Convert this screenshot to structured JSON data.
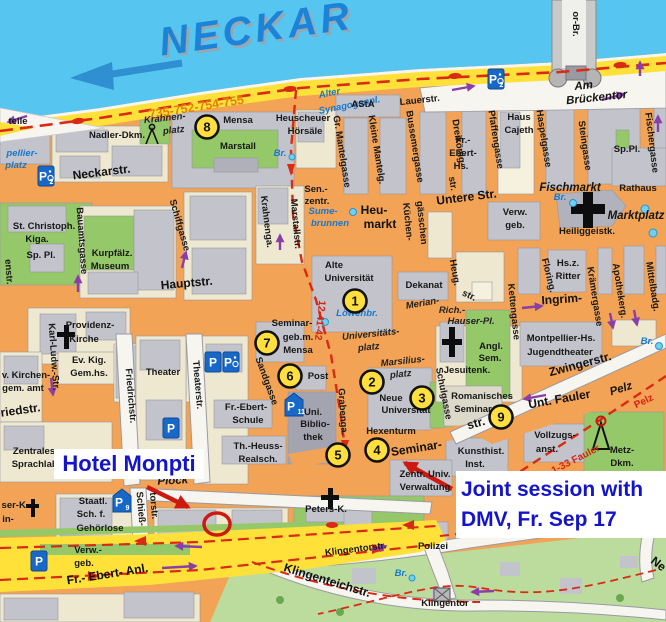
{
  "annotations": {
    "hotel_label": "Hotel Monpti",
    "joint_line1": "Joint session with",
    "joint_line2": "DMV, Fr. Sep 17"
  },
  "numbered_markers": [
    {
      "n": "1",
      "x": 355,
      "y": 301
    },
    {
      "n": "2",
      "x": 372,
      "y": 382
    },
    {
      "n": "3",
      "x": 422,
      "y": 398
    },
    {
      "n": "4",
      "x": 377,
      "y": 450
    },
    {
      "n": "5",
      "x": 338,
      "y": 455
    },
    {
      "n": "6",
      "x": 290,
      "y": 376
    },
    {
      "n": "7",
      "x": 267,
      "y": 343
    },
    {
      "n": "8",
      "x": 207,
      "y": 127
    },
    {
      "n": "9",
      "x": 501,
      "y": 417
    }
  ],
  "parking_icons": [
    {
      "p": "P",
      "sub": "2",
      "wheelchair": true,
      "shield": false,
      "x": 46,
      "y": 176
    },
    {
      "p": "P",
      "sub": "2",
      "wheelchair": true,
      "shield": false,
      "x": 496,
      "y": 79
    },
    {
      "p": "P",
      "sub": "",
      "wheelchair": false,
      "shield": false,
      "x": 213,
      "y": 362
    },
    {
      "p": "P",
      "sub": "",
      "wheelchair": true,
      "shield": false,
      "x": 231,
      "y": 362
    },
    {
      "p": "P",
      "sub": "",
      "wheelchair": false,
      "shield": false,
      "x": 171,
      "y": 428
    },
    {
      "p": "P",
      "sub": "11",
      "wheelchair": false,
      "shield": true,
      "x": 294,
      "y": 406
    },
    {
      "p": "P",
      "sub": "9",
      "wheelchair": false,
      "shield": true,
      "x": 122,
      "y": 502
    },
    {
      "p": "P",
      "sub": "",
      "wheelchair": false,
      "shield": false,
      "x": 39,
      "y": 561
    }
  ],
  "labels": [
    {
      "t": "NECKAR",
      "x": 258,
      "y": 42,
      "r": -8,
      "c": "neckar"
    },
    {
      "t": "735-752-754-755",
      "x": 197,
      "y": 111,
      "r": -9,
      "c": "route-orange"
    },
    {
      "t": "telle",
      "x": 18,
      "y": 124,
      "c": "pl"
    },
    {
      "t": "pellier-",
      "x": 22,
      "y": 156,
      "c": "wt"
    },
    {
      "t": "platz",
      "x": 16,
      "y": 168,
      "c": "wt"
    },
    {
      "t": "Nadler-Dkm.",
      "x": 117,
      "y": 138,
      "c": "pl"
    },
    {
      "t": "Krahnen-",
      "x": 165,
      "y": 121,
      "r": -6,
      "c": "ital"
    },
    {
      "t": "platz",
      "x": 174,
      "y": 133,
      "r": -6,
      "c": "ital"
    },
    {
      "t": "Mensa",
      "x": 238,
      "y": 123,
      "c": "pl"
    },
    {
      "t": "Marstall",
      "x": 238,
      "y": 149,
      "c": "pl"
    },
    {
      "t": "Heuscheuer",
      "x": 303,
      "y": 121,
      "c": "pl"
    },
    {
      "t": "Hörsäle",
      "x": 305,
      "y": 134,
      "c": "pl"
    },
    {
      "t": "Br.",
      "x": 280,
      "y": 156,
      "c": "wt"
    },
    {
      "t": "Alter",
      "x": 330,
      "y": 96,
      "r": -11,
      "c": "wt"
    },
    {
      "t": "Synagogenpl.",
      "x": 350,
      "y": 108,
      "r": -11,
      "c": "wt"
    },
    {
      "t": "AStA",
      "x": 363,
      "y": 107,
      "c": "pl"
    },
    {
      "t": "Lauerstr.",
      "x": 420,
      "y": 103,
      "r": -6,
      "c": "st",
      "s": 11
    },
    {
      "t": "or-Br.",
      "x": 573,
      "y": 24,
      "r": 90,
      "c": "st",
      "s": 11
    },
    {
      "t": "Am",
      "x": 584,
      "y": 89,
      "r": -6,
      "c": "ital-big"
    },
    {
      "t": "Brückentor",
      "x": 597,
      "y": 101,
      "r": -6,
      "c": "ital-big"
    },
    {
      "t": "Gr. Mantelgasse",
      "x": 339,
      "y": 152,
      "r": 81,
      "c": "st"
    },
    {
      "t": "Kleine Mantelg.",
      "x": 374,
      "y": 150,
      "r": 81,
      "c": "st"
    },
    {
      "t": "Bussemergasse",
      "x": 412,
      "y": 147,
      "r": 81,
      "c": "st"
    },
    {
      "t": "Dreikönig-",
      "x": 456,
      "y": 143,
      "r": 81,
      "c": "st"
    },
    {
      "t": "str.",
      "x": 450,
      "y": 184,
      "r": 81,
      "c": "st"
    },
    {
      "t": "Pfaffengasse",
      "x": 493,
      "y": 140,
      "r": 81,
      "c": "st"
    },
    {
      "t": "Haus",
      "x": 519,
      "y": 120,
      "c": "pl"
    },
    {
      "t": "Cajeth",
      "x": 519,
      "y": 133,
      "c": "pl"
    },
    {
      "t": "Fr.-",
      "x": 463,
      "y": 143,
      "c": "pl"
    },
    {
      "t": "Ebert-",
      "x": 463,
      "y": 156,
      "c": "pl"
    },
    {
      "t": "Hs.",
      "x": 461,
      "y": 169,
      "c": "pl"
    },
    {
      "t": "Haspelgasse",
      "x": 541,
      "y": 139,
      "r": 81,
      "c": "st"
    },
    {
      "t": "Steingasse",
      "x": 582,
      "y": 146,
      "r": 82,
      "c": "st"
    },
    {
      "t": "Sp.Pl.",
      "x": 627,
      "y": 152,
      "c": "pl"
    },
    {
      "t": "Fischergasse",
      "x": 649,
      "y": 143,
      "r": 83,
      "c": "st"
    },
    {
      "t": "Fischmarkt",
      "x": 570,
      "y": 191,
      "c": "ital-big"
    },
    {
      "t": "Rathaus",
      "x": 638,
      "y": 191,
      "c": "pl",
      "s": 11
    },
    {
      "t": "Br.",
      "x": 560,
      "y": 200,
      "c": "wt"
    },
    {
      "t": "Marktplatz",
      "x": 636,
      "y": 219,
      "c": "ital-big"
    },
    {
      "t": "Heiliggeistk.",
      "x": 587,
      "y": 234,
      "c": "pl",
      "s": 11
    },
    {
      "t": "Neckarstr.",
      "x": 102,
      "y": 176,
      "r": -7,
      "c": "big"
    },
    {
      "t": "Schiffgasse",
      "x": 177,
      "y": 226,
      "r": 74,
      "c": "st",
      "s": 11
    },
    {
      "t": "Bauamtsgasse",
      "x": 79,
      "y": 241,
      "r": 86,
      "c": "st"
    },
    {
      "t": "enstr.",
      "x": 6,
      "y": 272,
      "r": 86,
      "c": "st"
    },
    {
      "t": "St. Christoph.",
      "x": 44,
      "y": 229,
      "c": "pl"
    },
    {
      "t": "Kiga.",
      "x": 37,
      "y": 242,
      "c": "pl"
    },
    {
      "t": "Sp. Pl.",
      "x": 41,
      "y": 258,
      "c": "pl"
    },
    {
      "t": "Kurpfälz.",
      "x": 112,
      "y": 256,
      "c": "pl",
      "s": 10.5
    },
    {
      "t": "Museum",
      "x": 110,
      "y": 269,
      "c": "pl",
      "s": 10.5
    },
    {
      "t": "Krahnenga.",
      "x": 264,
      "y": 222,
      "r": 83,
      "c": "st"
    },
    {
      "t": "Marstallstr.",
      "x": 293,
      "y": 224,
      "r": 85,
      "c": "st"
    },
    {
      "t": "Sen.-",
      "x": 316,
      "y": 192,
      "c": "pl"
    },
    {
      "t": "zentr.",
      "x": 317,
      "y": 204,
      "c": "pl"
    },
    {
      "t": "Sume-",
      "x": 323,
      "y": 214,
      "c": "wt"
    },
    {
      "t": "brunnen",
      "x": 330,
      "y": 226,
      "c": "wt"
    },
    {
      "t": "Heu-",
      "x": 374,
      "y": 214,
      "c": "big"
    },
    {
      "t": "markt",
      "x": 380,
      "y": 228,
      "c": "big"
    },
    {
      "t": "Küchen-",
      "x": 405,
      "y": 222,
      "r": 84,
      "c": "st"
    },
    {
      "t": "gässchen",
      "x": 419,
      "y": 223,
      "r": 84,
      "c": "st"
    },
    {
      "t": "Untere Str.",
      "x": 467,
      "y": 201,
      "r": -7,
      "c": "big"
    },
    {
      "t": "Verw.",
      "x": 515,
      "y": 215,
      "c": "pl"
    },
    {
      "t": "geb.",
      "x": 515,
      "y": 228,
      "c": "pl"
    },
    {
      "t": "Hauptstr.",
      "x": 187,
      "y": 287,
      "r": -5,
      "c": "big",
      "s": 14
    },
    {
      "t": "Alte",
      "x": 334,
      "y": 268,
      "c": "pl",
      "s": 10.5
    },
    {
      "t": "Universität",
      "x": 349,
      "y": 281,
      "c": "pl",
      "s": 10.5
    },
    {
      "t": "Löwenbr.",
      "x": 357,
      "y": 316,
      "c": "wt"
    },
    {
      "t": "Dekanat",
      "x": 424,
      "y": 288,
      "c": "pl"
    },
    {
      "t": "Heug.",
      "x": 452,
      "y": 273,
      "r": 80,
      "c": "st"
    },
    {
      "t": "str.",
      "x": 468,
      "y": 298,
      "r": 25,
      "c": "st"
    },
    {
      "t": "Merian-",
      "x": 423,
      "y": 306,
      "r": -10,
      "c": "ital"
    },
    {
      "t": "Rich.-",
      "x": 452,
      "y": 313,
      "c": "ital"
    },
    {
      "t": "Hauser-Pl.",
      "x": 471,
      "y": 324,
      "c": "ital"
    },
    {
      "t": "Ingrim-",
      "x": 562,
      "y": 303,
      "r": -4,
      "c": "big"
    },
    {
      "t": "Kettengasse",
      "x": 511,
      "y": 312,
      "r": 84,
      "c": "st",
      "s": 11
    },
    {
      "t": "Floring.",
      "x": 546,
      "y": 276,
      "r": 76,
      "c": "st"
    },
    {
      "t": "Hs.z.",
      "x": 568,
      "y": 266,
      "c": "pl"
    },
    {
      "t": "Ritter",
      "x": 568,
      "y": 279,
      "c": "pl"
    },
    {
      "t": "Krämergasse",
      "x": 592,
      "y": 297,
      "r": 81,
      "c": "st"
    },
    {
      "t": "Apothekerg.",
      "x": 617,
      "y": 291,
      "r": 81,
      "c": "st"
    },
    {
      "t": "Mittelbadg.",
      "x": 650,
      "y": 287,
      "r": 81,
      "c": "st"
    },
    {
      "t": "Montpellier-Hs.",
      "x": 561,
      "y": 341,
      "c": "pl"
    },
    {
      "t": "Jugendtheater",
      "x": 560,
      "y": 355,
      "c": "pl"
    },
    {
      "t": "Zwingerstr.",
      "x": 581,
      "y": 368,
      "r": -15,
      "c": "big"
    },
    {
      "t": "Br.",
      "x": 647,
      "y": 344,
      "c": "wt"
    },
    {
      "t": "Angl.",
      "x": 491,
      "y": 349,
      "c": "pl"
    },
    {
      "t": "Sem.",
      "x": 490,
      "y": 361,
      "c": "pl"
    },
    {
      "t": "Jesuitenk.",
      "x": 467,
      "y": 373,
      "c": "pl"
    },
    {
      "t": "Schulgasse",
      "x": 441,
      "y": 394,
      "r": 79,
      "c": "st",
      "s": 11
    },
    {
      "t": "Romanisches",
      "x": 482,
      "y": 399,
      "c": "pl"
    },
    {
      "t": "Seminar",
      "x": 473,
      "y": 412,
      "c": "pl"
    },
    {
      "t": "Unt. Fauler",
      "x": 560,
      "y": 403,
      "r": -10,
      "c": "big"
    },
    {
      "t": "Pelz",
      "x": 622,
      "y": 392,
      "r": -18,
      "c": "ital-big"
    },
    {
      "t": "Pelz",
      "x": 645,
      "y": 404,
      "r": -26,
      "c": "red"
    },
    {
      "t": "1-33 Fauler",
      "x": 577,
      "y": 462,
      "r": -27,
      "c": "red"
    },
    {
      "t": "Vollzugs-",
      "x": 555,
      "y": 438,
      "c": "pl"
    },
    {
      "t": "anst.",
      "x": 547,
      "y": 452,
      "c": "pl"
    },
    {
      "t": "Metz-",
      "x": 622,
      "y": 453,
      "c": "pl"
    },
    {
      "t": "Dkm.",
      "x": 622,
      "y": 466,
      "c": "pl"
    },
    {
      "t": "Kunsthist.",
      "x": 481,
      "y": 454,
      "c": "pl"
    },
    {
      "t": "Inst.",
      "x": 475,
      "y": 467,
      "c": "pl"
    },
    {
      "t": "Seminar-",
      "x": 417,
      "y": 452,
      "r": -9,
      "c": "big"
    },
    {
      "t": "str.",
      "x": 477,
      "y": 427,
      "r": -15,
      "c": "big"
    },
    {
      "t": "Zentr. Univ.",
      "x": 425,
      "y": 477,
      "c": "pl"
    },
    {
      "t": "Verwaltung",
      "x": 425,
      "y": 490,
      "c": "pl"
    },
    {
      "t": "Universitäts-",
      "x": 371,
      "y": 337,
      "r": -6,
      "c": "ital",
      "s": 10.5
    },
    {
      "t": "platz",
      "x": 369,
      "y": 350,
      "r": -6,
      "c": "ital",
      "s": 10.5
    },
    {
      "t": "Marsilius-",
      "x": 403,
      "y": 364,
      "r": -6,
      "c": "ital",
      "s": 10.5
    },
    {
      "t": "platz",
      "x": 401,
      "y": 377,
      "r": -6,
      "c": "ital",
      "s": 10.5
    },
    {
      "t": "Neue",
      "x": 391,
      "y": 401,
      "c": "pl",
      "s": 10.5
    },
    {
      "t": "Universität",
      "x": 406,
      "y": 413,
      "c": "pl",
      "s": 10.5
    },
    {
      "t": "Hexenturm",
      "x": 391,
      "y": 434,
      "c": "pl"
    },
    {
      "t": "Grabenga.",
      "x": 340,
      "y": 412,
      "r": 86,
      "c": "st"
    },
    {
      "t": "12-41-42",
      "x": 317,
      "y": 320,
      "r": 96,
      "c": "red"
    },
    {
      "t": "Sandgasse",
      "x": 264,
      "y": 382,
      "r": 70,
      "c": "st"
    },
    {
      "t": "Seminar-",
      "x": 292,
      "y": 326,
      "c": "pl"
    },
    {
      "t": "geb.m.",
      "x": 298,
      "y": 340,
      "c": "pl"
    },
    {
      "t": "Mensa",
      "x": 298,
      "y": 353,
      "c": "pl"
    },
    {
      "t": "Post",
      "x": 318,
      "y": 379,
      "c": "pl"
    },
    {
      "t": "Uni.",
      "x": 313,
      "y": 415,
      "c": "pl"
    },
    {
      "t": "Biblio-",
      "x": 315,
      "y": 427,
      "c": "pl"
    },
    {
      "t": "thek",
      "x": 313,
      "y": 440,
      "c": "pl"
    },
    {
      "t": "Fr.-Ebert-",
      "x": 246,
      "y": 410,
      "c": "pl"
    },
    {
      "t": "Schule",
      "x": 248,
      "y": 423,
      "c": "pl"
    },
    {
      "t": "Th.-Heuss-",
      "x": 258,
      "y": 449,
      "c": "pl"
    },
    {
      "t": "Realsch.",
      "x": 258,
      "y": 462,
      "c": "pl"
    },
    {
      "t": "Providenz-",
      "x": 90,
      "y": 328,
      "c": "pl",
      "s": 10.5
    },
    {
      "t": "Kirche",
      "x": 84,
      "y": 342,
      "c": "pl",
      "s": 10.5
    },
    {
      "t": "Ev. Kig.",
      "x": 89,
      "y": 363,
      "c": "pl"
    },
    {
      "t": "Gem.hs.",
      "x": 89,
      "y": 376,
      "c": "pl"
    },
    {
      "t": "v. Kirchen-",
      "x": 26,
      "y": 378,
      "c": "pl"
    },
    {
      "t": "gem. amt",
      "x": 23,
      "y": 391,
      "c": "pl"
    },
    {
      "t": "riedstr.",
      "x": 21,
      "y": 414,
      "r": -8,
      "c": "big"
    },
    {
      "t": "Karl-Ludw.-Str.",
      "x": 51,
      "y": 357,
      "r": 86,
      "c": "st"
    },
    {
      "t": "Friedrichstr.",
      "x": 128,
      "y": 396,
      "r": 85,
      "c": "st",
      "s": 11
    },
    {
      "t": "Theaterstr.",
      "x": 195,
      "y": 385,
      "r": 85,
      "c": "st",
      "s": 11
    },
    {
      "t": "Theater",
      "x": 163,
      "y": 375,
      "c": "pl"
    },
    {
      "t": "Zentrales",
      "x": 34,
      "y": 454,
      "c": "pl"
    },
    {
      "t": "Sprachlab.",
      "x": 36,
      "y": 467,
      "c": "pl"
    },
    {
      "t": "Plöck",
      "x": 173,
      "y": 484,
      "r": -3,
      "c": "ital-big"
    },
    {
      "t": "Staatl.",
      "x": 93,
      "y": 504,
      "c": "pl"
    },
    {
      "t": "Sch. f.",
      "x": 91,
      "y": 517,
      "c": "pl"
    },
    {
      "t": "Gehörlose",
      "x": 100,
      "y": 531,
      "c": "pl"
    },
    {
      "t": "Schieß-",
      "x": 138,
      "y": 509,
      "r": 85,
      "c": "st"
    },
    {
      "t": "torstr.",
      "x": 151,
      "y": 506,
      "r": 85,
      "c": "st"
    },
    {
      "t": "ser-K.",
      "x": 15,
      "y": 508,
      "c": "pl"
    },
    {
      "t": "in-",
      "x": 8,
      "y": 522,
      "c": "pl"
    },
    {
      "t": "Peters-K.",
      "x": 326,
      "y": 512,
      "c": "pl",
      "s": 10.5
    },
    {
      "t": "Verw.-",
      "x": 88,
      "y": 553,
      "c": "pl"
    },
    {
      "t": "geb.",
      "x": 84,
      "y": 566,
      "c": "pl"
    },
    {
      "t": "Fr.- Ebert- Anl.",
      "x": 108,
      "y": 578,
      "r": -9,
      "c": "big",
      "s": 13
    },
    {
      "t": "Klingentorstr.",
      "x": 356,
      "y": 552,
      "r": -7,
      "c": "st",
      "s": 10
    },
    {
      "t": "Klingenteichstr.",
      "x": 326,
      "y": 584,
      "r": 17,
      "c": "big"
    },
    {
      "t": "Polizei",
      "x": 433,
      "y": 549,
      "c": "pl"
    },
    {
      "t": "Klingentor",
      "x": 445,
      "y": 606,
      "c": "pl",
      "s": 10.5
    },
    {
      "t": "Br.",
      "x": 401,
      "y": 576,
      "c": "wt"
    },
    {
      "t": "Ne",
      "x": 656,
      "y": 567,
      "r": 38,
      "c": "big"
    }
  ],
  "colors": {
    "water": "#56c5ef",
    "water_label": "#1878cc",
    "road_yellow": "#ffe13a",
    "street_orange": "#f2a355",
    "block_beige": "#efe8d1",
    "building_gray": "#c3c3cc",
    "building_dark": "#a4a4b0",
    "green": "#94c868",
    "park_green": "#bcdc9e",
    "road_white": "#f7f5ef",
    "route_red": "#da2a14",
    "oneway_purple": "#8a3fa8",
    "annotation_blue": "#1414cc",
    "annotation_red": "#cc1a10",
    "bus_label_orange": "#e0820a",
    "marker_yellow": "#ffdf3d",
    "neckar_blue": "#1b84d8"
  }
}
